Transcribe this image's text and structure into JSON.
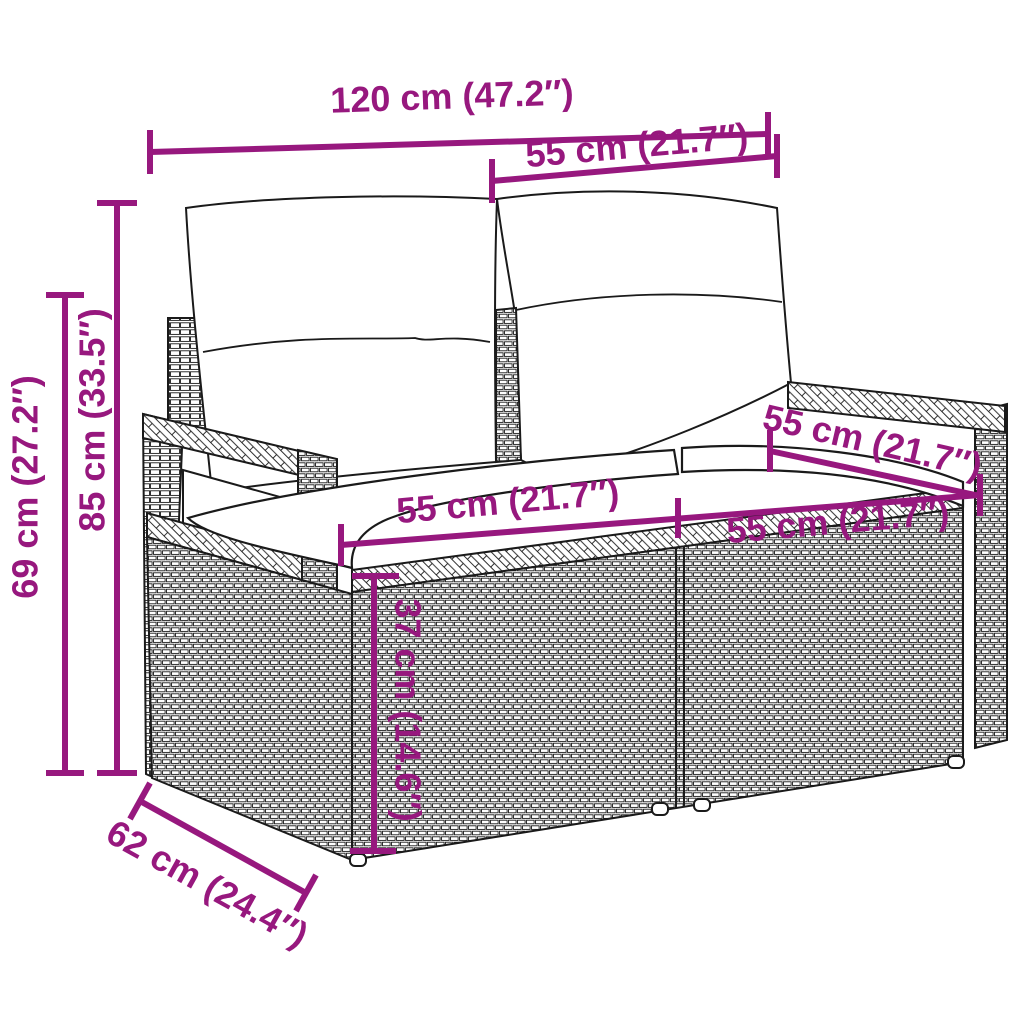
{
  "figure": {
    "product": "Poly rattan 2-seater garden sofa with cushions",
    "style": "technical dimension line drawing",
    "background_color": "#ffffff",
    "outline_color": "#1a1a1a",
    "dimension_color": "#97187e"
  },
  "dimensions": {
    "total_width": "120 cm (47.2″)",
    "section_width_top": "55 cm (21.7″)",
    "back_height": "85 cm (33.5″)",
    "arm_height": "69 cm (27.2″)",
    "seat_width_left": "55 cm (21.7″)",
    "seat_width_right": "55 cm (21.7″)",
    "armrest_depth": "55 cm (21.7″)",
    "seat_height": "37 cm (14.6″)",
    "base_depth": "62 cm (24.4″)"
  }
}
